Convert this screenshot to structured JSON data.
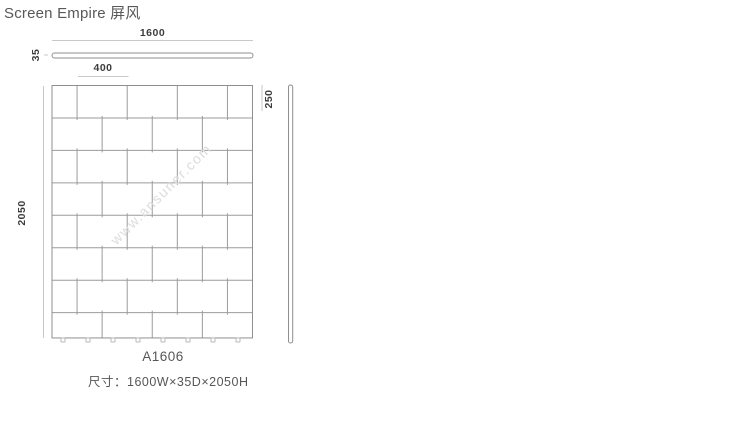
{
  "page": {
    "title": "Screen Empire 屏风",
    "product_code": "A1606",
    "size_label": "尺寸：1600W×35D×2050H",
    "watermark": "www.ansuner.com"
  },
  "dimensions": {
    "width": "1600",
    "module_width": "400",
    "depth": "35",
    "height": "2050",
    "module_height": "250"
  },
  "drawing": {
    "type": "technical-drawing",
    "panel_mm": {
      "width": 1600,
      "depth": 35,
      "height": 2050
    },
    "brick_module_mm": {
      "width": 400,
      "height": 250
    },
    "rows": 8,
    "row_patterns": {
      "odd_rows": [
        200,
        400,
        400,
        400,
        200
      ],
      "even_rows": [
        400,
        400,
        400,
        400
      ]
    },
    "feet_count": 8,
    "colors": {
      "line": "#9b9b9b",
      "outline": "#8f8f8f",
      "dim_line": "#c9c9c9",
      "feet": "#b8b8b8",
      "dim_text": "#3d3d3d",
      "text": "#565656",
      "watermark": "#dcdcdc"
    }
  }
}
